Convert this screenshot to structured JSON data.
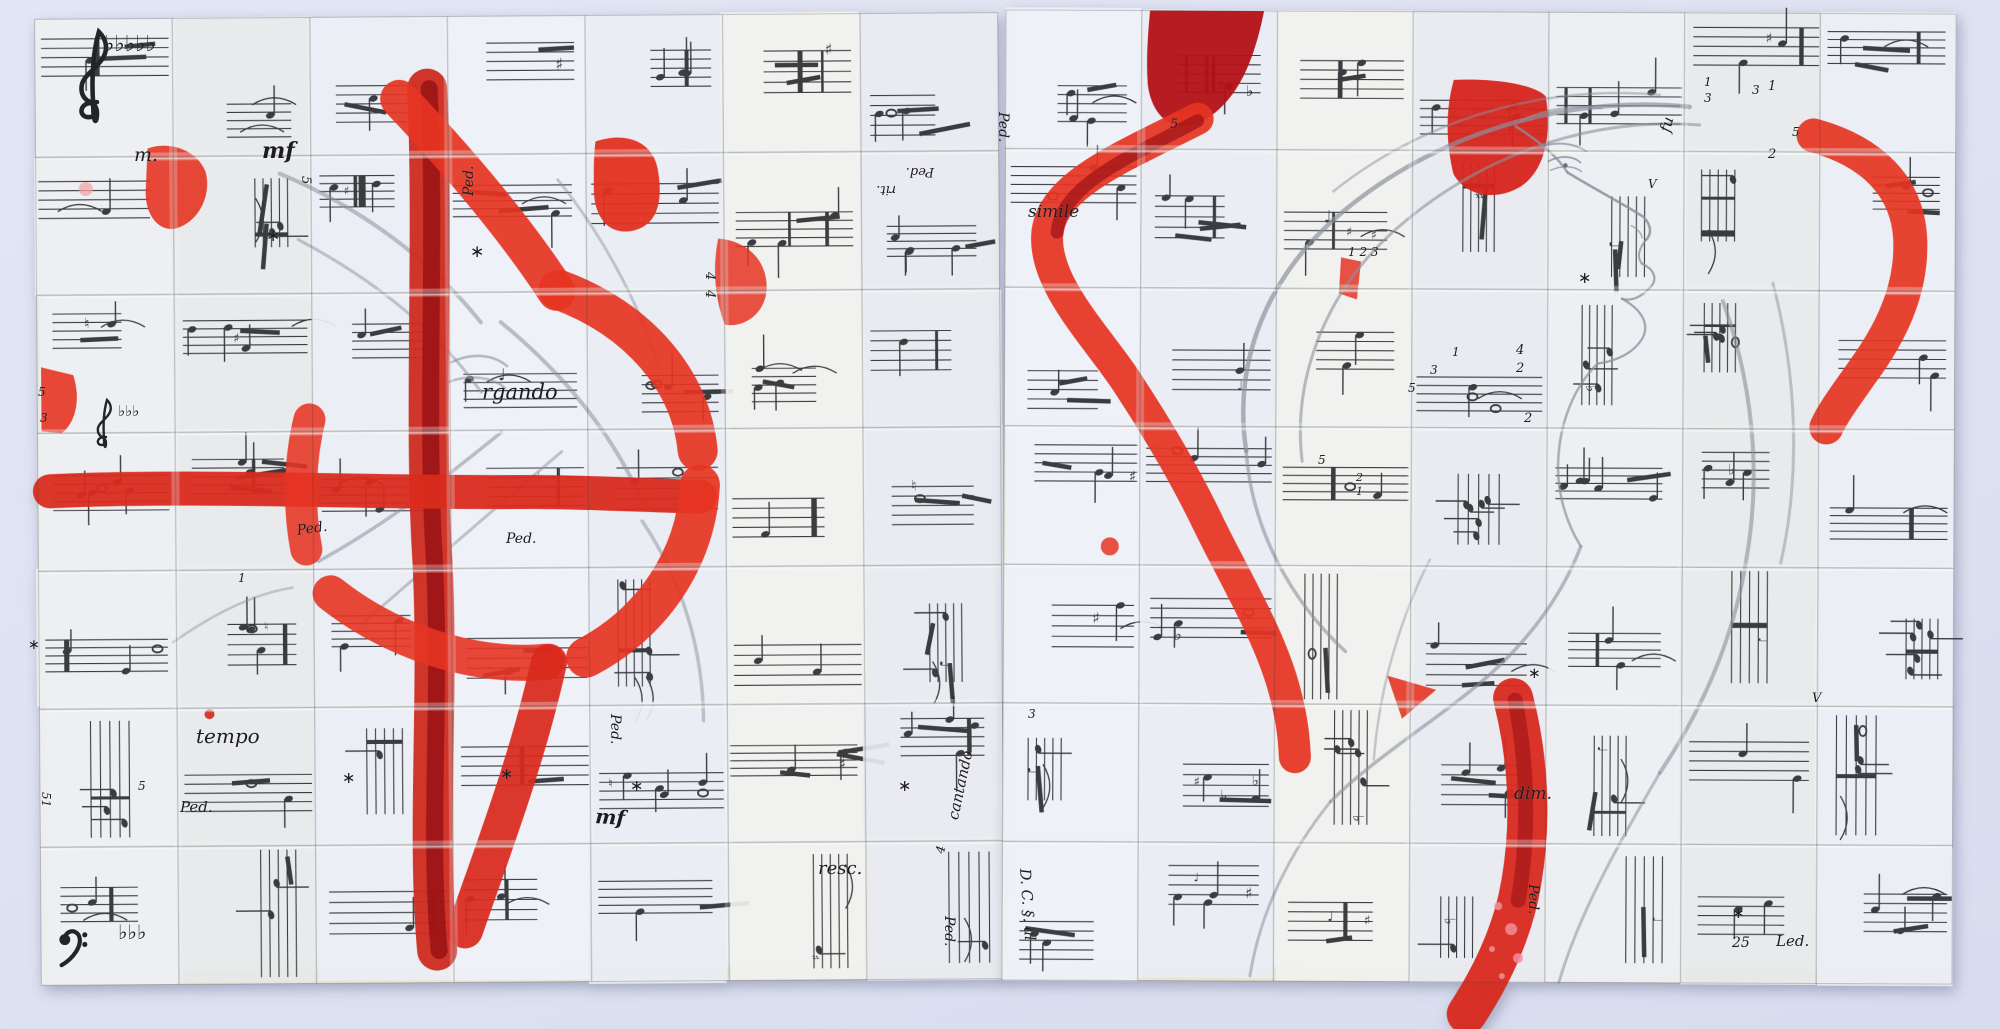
{
  "background": {
    "color": "#dde1f1"
  },
  "palette": {
    "paper": [
      "#eef1f6",
      "#e9edf3",
      "#f1f2ee",
      "#e8eaf0",
      "#edeff1",
      "#e7e9ea",
      "#eceef4"
    ],
    "cream": "#e7e5d5",
    "ink": "#232427",
    "pencil": "#8b919c",
    "red_bright": "#e63422",
    "red_mid": "#d0281c",
    "red_dark": "#951014",
    "pink": "#f2a6a6"
  },
  "panels": [
    {
      "id": "left-panel",
      "x": 38,
      "y": 16,
      "w": 963,
      "h": 966,
      "rot": -0.4,
      "cols": 7,
      "rows": 7,
      "seed": 11
    },
    {
      "id": "right-panel",
      "x": 1004,
      "y": 12,
      "w": 950,
      "h": 970,
      "rot": 0.25,
      "cols": 7,
      "rows": 7,
      "seed": 77
    }
  ],
  "red_shapes": [
    {
      "panel": 0,
      "type": "stroke",
      "d": "M430,88 C436,240 424,420 432,560 C438,700 424,830 434,950",
      "color": "#cf2a1e",
      "w": 40,
      "o": 0.95
    },
    {
      "panel": 0,
      "type": "stroke",
      "d": "M432,88 C438,240 426,420 434,560 C440,700 426,830 436,950",
      "color": "#951014",
      "w": 17,
      "o": 0.8
    },
    {
      "panel": 0,
      "type": "stroke",
      "d": "M50,488 C200,482 360,492 520,492 C580,492 640,496 700,498",
      "color": "#d92b1d",
      "w": 34,
      "o": 0.95
    },
    {
      "panel": 0,
      "type": "stroke",
      "d": "M402,98 C460,160 515,225 558,292",
      "color": "#e63422",
      "w": 38,
      "o": 0.92
    },
    {
      "panel": 0,
      "type": "stroke",
      "d": "M560,290 C640,320 692,382 698,452",
      "color": "#e63422",
      "w": 40,
      "o": 0.92
    },
    {
      "panel": 0,
      "type": "stroke",
      "d": "M700,486 C696,560 650,625 585,658",
      "color": "#e63422",
      "w": 40,
      "o": 0.92
    },
    {
      "panel": 0,
      "type": "stroke",
      "d": "M545,662 C470,668 390,640 330,592",
      "color": "#e63422",
      "w": 36,
      "o": 0.9
    },
    {
      "panel": 0,
      "type": "stroke",
      "d": "M306,548 C298,505 300,458 310,418",
      "color": "#e63422",
      "w": 32,
      "o": 0.88
    },
    {
      "panel": 0,
      "type": "stroke",
      "d": "M548,662 C525,762 492,845 462,930",
      "color": "#d9291d",
      "w": 36,
      "o": 0.93
    },
    {
      "panel": 0,
      "type": "fill",
      "d": "M598,142 C628,132 655,142 660,170 C666,205 658,228 632,232 C608,235 596,215 596,190 C596,172 596,155 598,142 Z",
      "color": "#e23120",
      "o": 0.95
    },
    {
      "panel": 0,
      "type": "fill",
      "d": "M150,146 C172,138 200,148 208,170 C214,194 200,220 178,226 C158,230 146,208 148,186 Z",
      "color": "#e63422",
      "o": 0.9
    },
    {
      "panel": 0,
      "type": "fill",
      "d": "M42,364 L74,372 C82,396 76,420 62,430 L42,428 Z",
      "color": "#e63422",
      "o": 0.9
    },
    {
      "panel": 0,
      "type": "fill",
      "d": "M720,240 C748,242 770,262 768,292 C766,316 744,330 726,326 C716,300 714,268 720,240 Z",
      "color": "#e63422",
      "o": 0.85
    },
    {
      "panel": 0,
      "type": "dot",
      "x": 208,
      "y": 712,
      "r": 5,
      "color": "#d0281c",
      "o": 0.9
    },
    {
      "panel": 0,
      "type": "dot",
      "x": 88,
      "y": 186,
      "r": 7,
      "color": "#f2a6a6",
      "o": 0.75
    },
    {
      "panel": 1,
      "type": "fill",
      "d": "M1148,12 L1262,12 C1252,62 1236,104 1198,124 C1172,136 1150,118 1146,86 C1144,60 1146,34 1148,12 Z",
      "color": "#b31116",
      "o": 0.95
    },
    {
      "panel": 1,
      "type": "stroke",
      "d": "M1196,120 C1118,160 1048,188 1046,238 C1044,286 1094,336 1124,380 C1156,428 1186,478 1210,528 C1236,580 1266,630 1282,680 C1292,712 1295,736 1296,758",
      "color": "#e63422",
      "w": 32,
      "o": 0.93
    },
    {
      "panel": 1,
      "type": "stroke",
      "d": "M1196,122 C1130,158 1060,186 1056,234",
      "color": "#951014",
      "w": 13,
      "o": 0.65
    },
    {
      "panel": 1,
      "type": "fill",
      "d": "M1452,80 C1492,78 1532,84 1544,96 C1550,132 1545,168 1520,186 C1494,202 1464,196 1452,174 C1444,142 1444,108 1452,80 Z",
      "color": "#d6241c",
      "o": 0.95
    },
    {
      "panel": 1,
      "type": "stroke",
      "d": "M1812,134 C1872,150 1906,186 1909,236 C1912,288 1889,333 1862,370 C1844,396 1832,412 1826,426",
      "color": "#e63422",
      "w": 34,
      "o": 0.92
    },
    {
      "panel": 1,
      "type": "stroke",
      "d": "M1514,698 C1530,760 1533,822 1523,882 C1515,932 1493,977 1469,1014",
      "color": "#d9291d",
      "w": 40,
      "o": 0.95
    },
    {
      "panel": 1,
      "type": "stroke",
      "d": "M1516,700 C1530,770 1530,840 1520,900",
      "color": "#9a1216",
      "w": 15,
      "o": 0.6
    },
    {
      "panel": 1,
      "type": "fill",
      "d": "M1388,676 L1437,690 L1403,719 Z",
      "color": "#e63422",
      "o": 0.9
    },
    {
      "panel": 1,
      "type": "fill",
      "d": "M1340,258 L1360,262 L1356,300 L1338,294 Z",
      "color": "#e63422",
      "o": 0.85
    },
    {
      "panel": 1,
      "type": "dot",
      "x": 1110,
      "y": 548,
      "r": 9,
      "color": "#e63422",
      "o": 0.85
    },
    {
      "panel": 1,
      "type": "dot",
      "x": 1500,
      "y": 906,
      "r": 4,
      "color": "#f08f9b",
      "o": 0.85
    },
    {
      "panel": 1,
      "type": "dot",
      "x": 1513,
      "y": 929,
      "r": 6,
      "color": "#f08f9b",
      "o": 0.85
    },
    {
      "panel": 1,
      "type": "dot",
      "x": 1494,
      "y": 949,
      "r": 3,
      "color": "#f08f9b",
      "o": 0.85
    },
    {
      "panel": 1,
      "type": "dot",
      "x": 1520,
      "y": 958,
      "r": 5,
      "color": "#f08f9b",
      "o": 0.85
    },
    {
      "panel": 1,
      "type": "dot",
      "x": 1504,
      "y": 976,
      "r": 3,
      "color": "#f08f9b",
      "o": 0.85
    }
  ],
  "pencil_strokes": [
    {
      "d": "M282,172 C360,205 432,258 482,322",
      "w": 4,
      "o": 0.55
    },
    {
      "d": "M300,238 C378,280 440,332 482,392",
      "w": 3,
      "o": 0.5
    },
    {
      "d": "M318,560 C392,520 452,472 502,432",
      "w": 3.5,
      "o": 0.55
    },
    {
      "d": "M362,622 C432,562 502,502 562,452",
      "w": 3,
      "o": 0.5
    },
    {
      "d": "M502,322 C562,372 612,432 642,502",
      "w": 4,
      "o": 0.55
    },
    {
      "d": "M172,640 C212,612 252,592 292,586",
      "w": 2.5,
      "o": 0.45
    },
    {
      "d": "M642,522 C682,582 702,652 702,722",
      "w": 3.5,
      "o": 0.5
    },
    {
      "d": "M452,362 C472,352 494,354 508,366",
      "w": 2.5,
      "o": 0.6
    },
    {
      "d": "M448,382 C468,374 492,376 506,388",
      "w": 2.5,
      "o": 0.55
    },
    {
      "d": "M560,180 C600,230 640,300 660,370",
      "w": 3,
      "o": 0.45
    },
    {
      "d": "M1688,106 C1560,94 1432,136 1342,212 C1266,276 1232,362 1246,452",
      "w": 4.5,
      "o": 0.7
    },
    {
      "d": "M1698,124 C1580,116 1472,160 1392,232 C1322,296 1292,382 1302,462",
      "w": 3,
      "o": 0.6
    },
    {
      "d": "M1658,94 C1540,84 1422,120 1332,192",
      "w": 2.5,
      "o": 0.5
    },
    {
      "d": "M1246,452 C1252,532 1292,602 1346,652",
      "w": 3.5,
      "o": 0.6
    },
    {
      "d": "M1514,126 C1536,140 1556,156 1566,172",
      "w": 2.5,
      "o": 0.8
    },
    {
      "d": "M1566,172 C1592,188 1620,202 1642,216 C1650,224 1651,233 1645,239",
      "w": 2.5,
      "o": 0.85
    },
    {
      "d": "M1645,239 C1637,249 1636,257 1641,263",
      "w": 2,
      "o": 0.8
    },
    {
      "d": "M1641,263 C1654,269 1657,279 1649,287 C1640,297 1629,301 1621,298",
      "w": 2.2,
      "o": 0.8
    },
    {
      "d": "M1621,298 C1641,309 1649,323 1642,337 C1633,353 1614,361 1597,363",
      "w": 2.2,
      "o": 0.8
    },
    {
      "d": "M1597,363 C1574,386 1559,422 1558,462 C1557,492 1566,522 1581,546",
      "w": 2.5,
      "o": 0.7
    },
    {
      "d": "M1547,161 C1558,155 1571,155 1579,162",
      "w": 1.8,
      "o": 0.85
    },
    {
      "d": "M1549,170 C1560,165 1572,165 1580,171",
      "w": 1.5,
      "o": 0.75
    },
    {
      "d": "M1538,147 C1554,141 1572,142 1585,151",
      "w": 2,
      "o": 0.75
    },
    {
      "d": "M1630,225 C1636,228 1640,232 1641,237",
      "w": 1.5,
      "o": 0.75
    },
    {
      "d": "M1581,546 C1560,602 1520,652 1470,692 C1420,732 1372,762 1332,802",
      "w": 3.5,
      "o": 0.6
    },
    {
      "d": "M1722,300 C1752,382 1762,472 1746,562 C1733,642 1701,712 1661,772",
      "w": 4,
      "o": 0.6
    },
    {
      "d": "M1772,282 C1796,372 1801,472 1781,562",
      "w": 3,
      "o": 0.5
    },
    {
      "d": "M1332,802 C1292,852 1262,912 1252,977",
      "w": 3,
      "o": 0.55
    },
    {
      "d": "M1661,772 C1621,842 1581,912 1561,982",
      "w": 3,
      "o": 0.55
    },
    {
      "d": "M1520,120 C1545,108 1575,104 1600,108",
      "w": 2,
      "o": 0.6
    },
    {
      "d": "M1430,560 C1400,620 1380,690 1375,760",
      "w": 2.5,
      "o": 0.45
    }
  ],
  "eye_dot": {
    "x": 1564,
    "y": 165,
    "r": 2.2
  },
  "clefs": [
    {
      "type": "treble",
      "x": 78,
      "y": 28,
      "s": 1.9
    },
    {
      "type": "treble",
      "x": 96,
      "y": 398,
      "s": 1.0
    },
    {
      "type": "bass",
      "x": 60,
      "y": 930,
      "s": 1.6
    }
  ],
  "labels": [
    {
      "t": "m.",
      "x": 134,
      "y": 146,
      "s": 19
    },
    {
      "t": "mf",
      "x": 262,
      "y": 140,
      "s": 22,
      "b": true
    },
    {
      "t": "∗",
      "x": 266,
      "y": 228,
      "s": 17,
      "g": true
    },
    {
      "t": "∗",
      "x": 470,
      "y": 244,
      "s": 17,
      "g": true
    },
    {
      "t": "Ped.",
      "x": 462,
      "y": 196,
      "s": 14,
      "r": -90
    },
    {
      "t": "rit.",
      "x": 896,
      "y": 196,
      "s": 13,
      "r": 180
    },
    {
      "t": "Ped.",
      "x": 934,
      "y": 178,
      "s": 13,
      "r": 180
    },
    {
      "t": "rgando",
      "x": 482,
      "y": 382,
      "s": 21
    },
    {
      "t": "Ped.",
      "x": 296,
      "y": 524,
      "s": 14,
      "r": -8
    },
    {
      "t": "Ped.",
      "x": 506,
      "y": 532,
      "s": 14
    },
    {
      "t": "5",
      "x": 312,
      "y": 176,
      "s": 13,
      "r": 90
    },
    {
      "t": "4",
      "x": 716,
      "y": 272,
      "s": 13,
      "r": 90
    },
    {
      "t": "4",
      "x": 716,
      "y": 290,
      "s": 13,
      "r": 90
    },
    {
      "t": "5",
      "x": 38,
      "y": 386,
      "s": 12
    },
    {
      "t": "3",
      "x": 40,
      "y": 412,
      "s": 12
    },
    {
      "t": "♭♭♭",
      "x": 118,
      "y": 404,
      "s": 15,
      "g": true
    },
    {
      "t": "♭♭♭♭♭",
      "x": 104,
      "y": 34,
      "s": 22,
      "g": true
    },
    {
      "t": "tempo",
      "x": 196,
      "y": 726,
      "s": 20
    },
    {
      "t": "1",
      "x": 238,
      "y": 572,
      "s": 12
    },
    {
      "t": "5",
      "x": 138,
      "y": 780,
      "s": 12
    },
    {
      "t": "51",
      "x": 52,
      "y": 792,
      "s": 12,
      "r": 90
    },
    {
      "t": "Ped.",
      "x": 180,
      "y": 800,
      "s": 15
    },
    {
      "t": "∗",
      "x": 342,
      "y": 770,
      "s": 16,
      "g": true
    },
    {
      "t": "∗",
      "x": 500,
      "y": 766,
      "s": 16,
      "g": true
    },
    {
      "t": "mf",
      "x": 596,
      "y": 806,
      "s": 20,
      "b": true,
      "r": 4
    },
    {
      "t": "∗",
      "x": 630,
      "y": 778,
      "s": 16,
      "g": true
    },
    {
      "t": "Ped.",
      "x": 622,
      "y": 714,
      "s": 14,
      "r": 90
    },
    {
      "t": "∗",
      "x": 898,
      "y": 778,
      "s": 16,
      "g": true
    },
    {
      "t": "∗",
      "x": 28,
      "y": 638,
      "s": 14,
      "g": true
    },
    {
      "t": "Ped.",
      "x": 956,
      "y": 916,
      "s": 14,
      "r": 90
    },
    {
      "t": "cantando",
      "x": 946,
      "y": 818,
      "s": 15,
      "r": -78
    },
    {
      "t": "4",
      "x": 934,
      "y": 852,
      "s": 12,
      "r": -78
    },
    {
      "t": "resc.",
      "x": 818,
      "y": 860,
      "s": 18
    },
    {
      "t": "♭♭♭",
      "x": 118,
      "y": 922,
      "s": 20,
      "g": true
    },
    {
      "t": "Ped.",
      "x": 1010,
      "y": 112,
      "s": 14,
      "r": 90
    },
    {
      "t": "simile",
      "x": 1028,
      "y": 204,
      "s": 17
    },
    {
      "t": "5",
      "x": 1170,
      "y": 118,
      "s": 13
    },
    {
      "t": "♭",
      "x": 1246,
      "y": 84,
      "s": 15,
      "g": true
    },
    {
      "t": "fu",
      "x": 1658,
      "y": 130,
      "s": 15,
      "r": -75
    },
    {
      "t": "1",
      "x": 1704,
      "y": 76,
      "s": 12
    },
    {
      "t": "3",
      "x": 1704,
      "y": 92,
      "s": 12
    },
    {
      "t": "3",
      "x": 1752,
      "y": 84,
      "s": 12
    },
    {
      "t": "1",
      "x": 1768,
      "y": 80,
      "s": 13
    },
    {
      "t": "2",
      "x": 1768,
      "y": 148,
      "s": 13
    },
    {
      "t": "5",
      "x": 1792,
      "y": 126,
      "s": 12
    },
    {
      "t": "1 2 3",
      "x": 1348,
      "y": 246,
      "s": 12
    },
    {
      "t": "4",
      "x": 1516,
      "y": 344,
      "s": 13
    },
    {
      "t": "2",
      "x": 1516,
      "y": 362,
      "s": 13
    },
    {
      "t": "1",
      "x": 1452,
      "y": 346,
      "s": 12
    },
    {
      "t": "3",
      "x": 1430,
      "y": 364,
      "s": 12
    },
    {
      "t": "5",
      "x": 1408,
      "y": 382,
      "s": 12
    },
    {
      "t": "2",
      "x": 1524,
      "y": 412,
      "s": 13
    },
    {
      "t": "5",
      "x": 1318,
      "y": 454,
      "s": 12
    },
    {
      "t": "2",
      "x": 1356,
      "y": 472,
      "s": 11
    },
    {
      "t": "1",
      "x": 1356,
      "y": 486,
      "s": 11
    },
    {
      "t": "∗",
      "x": 1578,
      "y": 270,
      "s": 16,
      "g": true
    },
    {
      "t": "∗",
      "x": 1528,
      "y": 666,
      "s": 15,
      "g": true
    },
    {
      "t": "3",
      "x": 1028,
      "y": 708,
      "s": 12
    },
    {
      "t": "dim.",
      "x": 1514,
      "y": 786,
      "s": 17
    },
    {
      "t": "∗",
      "x": 1732,
      "y": 906,
      "s": 15,
      "g": true
    },
    {
      "t": "25",
      "x": 1732,
      "y": 936,
      "s": 14
    },
    {
      "t": "Led.",
      "x": 1776,
      "y": 934,
      "s": 15
    },
    {
      "t": "Ped.",
      "x": 1540,
      "y": 884,
      "s": 14,
      "r": 90
    },
    {
      "t": "D. C. §. al",
      "x": 1032,
      "y": 868,
      "s": 15,
      "r": 86
    },
    {
      "t": "V",
      "x": 1648,
      "y": 178,
      "s": 12
    },
    {
      "t": "V",
      "x": 1812,
      "y": 692,
      "s": 13
    }
  ]
}
